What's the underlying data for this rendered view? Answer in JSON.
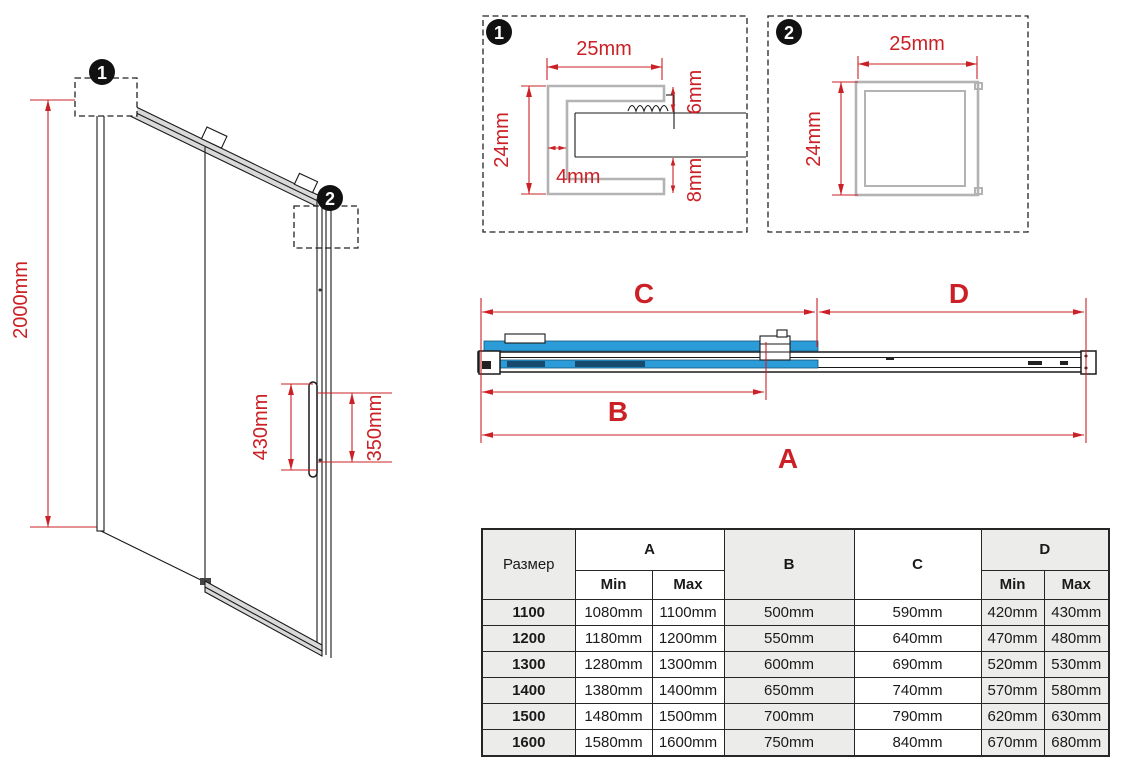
{
  "colors": {
    "dimension_red": "#cb2026",
    "glass_blue": "#2b9cd8",
    "glass_blue_dark": "#174a6e",
    "profile_gray": "#b3b3b3",
    "rail_gray": "#d9d9d9",
    "table_shaded_cell": "#ecedeb"
  },
  "iso_view": {
    "marker1_badge": "1",
    "marker2_badge": "2",
    "height_dim": "2000mm",
    "handle_length_dim": "430mm",
    "handle_holes_dim": "350mm"
  },
  "detail_1": {
    "badge": "1",
    "width_dim": "25mm",
    "height_dim": "24mm",
    "top_gap_dim": "6mm",
    "wall_dim": "4mm",
    "bottom_gap_dim": "8mm"
  },
  "detail_2": {
    "badge": "2",
    "width_dim": "25mm",
    "height_dim": "24mm"
  },
  "plan_view": {
    "dim_c": "C",
    "dim_d": "D",
    "dim_b": "B",
    "dim_a": "A"
  },
  "size_table": {
    "size_col_header": "Размер",
    "col_a": "A",
    "col_b": "B",
    "col_c": "C",
    "col_d": "D",
    "min_label": "Min",
    "max_label": "Max",
    "rows": [
      {
        "size": "1100",
        "a_min": "1080mm",
        "a_max": "1100mm",
        "b": "500mm",
        "c": "590mm",
        "d_min": "420mm",
        "d_max": "430mm"
      },
      {
        "size": "1200",
        "a_min": "1180mm",
        "a_max": "1200mm",
        "b": "550mm",
        "c": "640mm",
        "d_min": "470mm",
        "d_max": "480mm"
      },
      {
        "size": "1300",
        "a_min": "1280mm",
        "a_max": "1300mm",
        "b": "600mm",
        "c": "690mm",
        "d_min": "520mm",
        "d_max": "530mm"
      },
      {
        "size": "1400",
        "a_min": "1380mm",
        "a_max": "1400mm",
        "b": "650mm",
        "c": "740mm",
        "d_min": "570mm",
        "d_max": "580mm"
      },
      {
        "size": "1500",
        "a_min": "1480mm",
        "a_max": "1500mm",
        "b": "700mm",
        "c": "790mm",
        "d_min": "620mm",
        "d_max": "630mm"
      },
      {
        "size": "1600",
        "a_min": "1580mm",
        "a_max": "1600mm",
        "b": "750mm",
        "c": "840mm",
        "d_min": "670mm",
        "d_max": "680mm"
      }
    ]
  }
}
